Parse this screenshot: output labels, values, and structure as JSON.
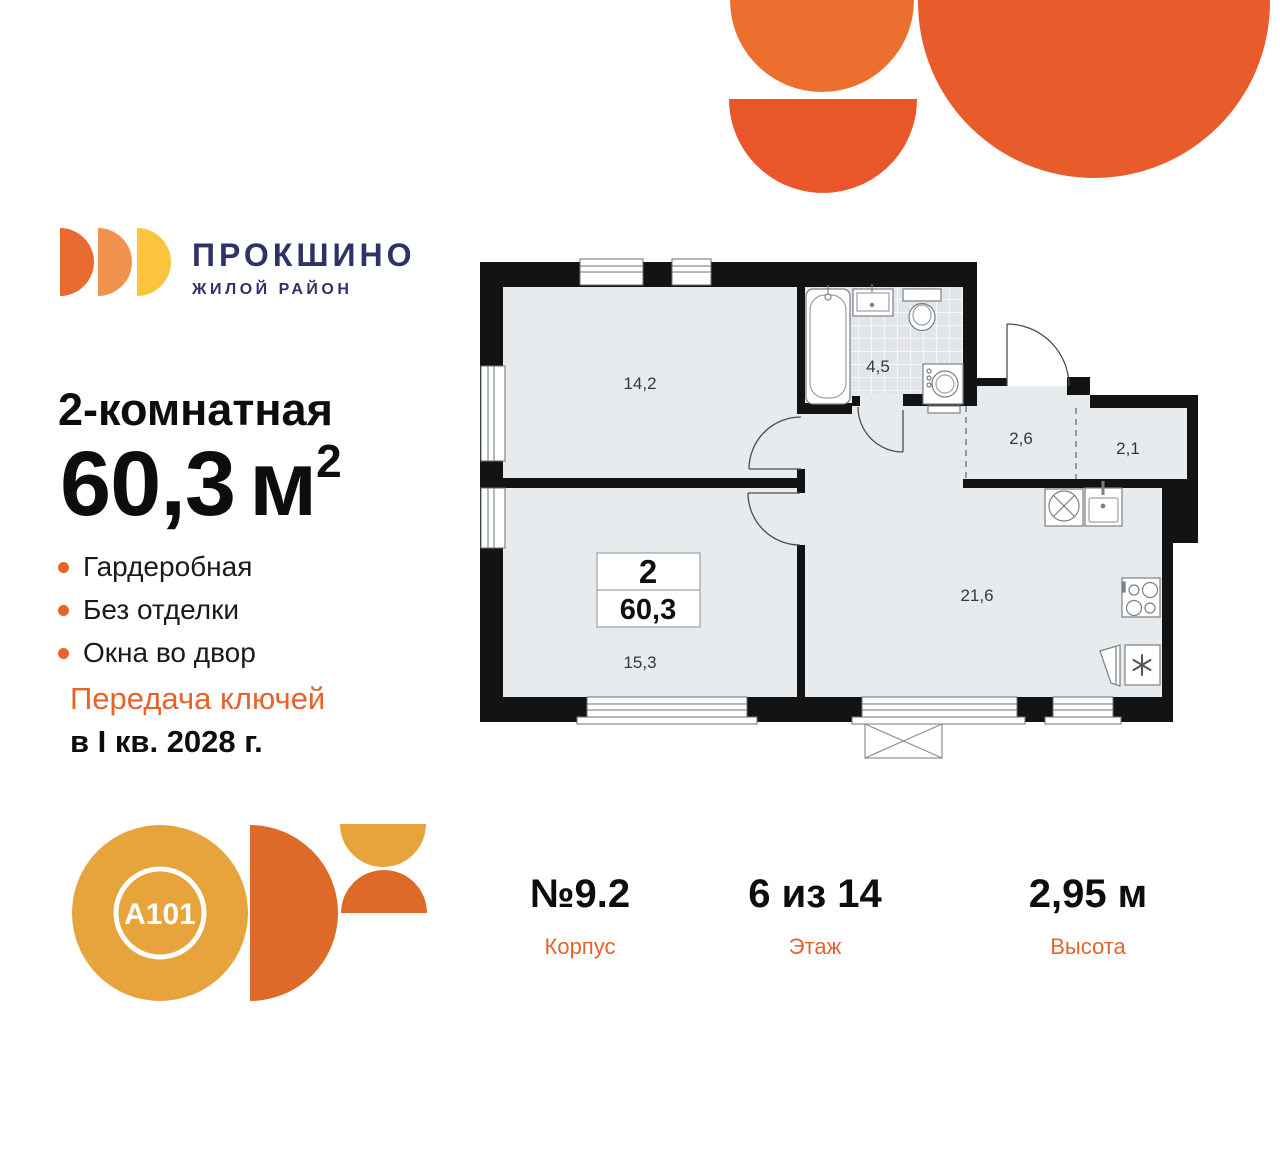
{
  "colors": {
    "accent_orange": "#E8622B",
    "brand_navy": "#2E3268",
    "logo_arcs": [
      "#E96A2E",
      "#F0924E",
      "#FBC43C"
    ],
    "decor_shapes": [
      "#ED6F2F",
      "#E8562A",
      "#E85C2B"
    ],
    "a101_gold": "#E8A43C",
    "a101_orange": "#DD6A28",
    "plan_wall": "#131313",
    "plan_floor": "#E7EBEE"
  },
  "brand": {
    "name": "ПРОКШИНО",
    "tagline": "ЖИЛОЙ РАЙОН"
  },
  "listing": {
    "type_title": "2-комнатная",
    "area_value": "60,3",
    "area_unit": "м",
    "area_sup": "2",
    "features": [
      "Гардеробная",
      "Без отделки",
      "Окна во двор"
    ],
    "handover_line1": "Передача ключей",
    "handover_line2": "в I кв. 2028 г."
  },
  "floorplan": {
    "badge": {
      "rooms": "2",
      "area": "60,3"
    },
    "labels": {
      "room1": "14,2",
      "bathroom": "4,5",
      "hall": "2,6",
      "wardrobe": "2,1",
      "kitchen": "21,6",
      "room2": "15,3"
    }
  },
  "details": [
    {
      "value": "№9.2",
      "label": "Корпус"
    },
    {
      "value": "6 из 14",
      "label": "Этаж"
    },
    {
      "value": "2,95 м",
      "label": "Высота"
    }
  ],
  "developer": {
    "logo_text": "A101"
  }
}
